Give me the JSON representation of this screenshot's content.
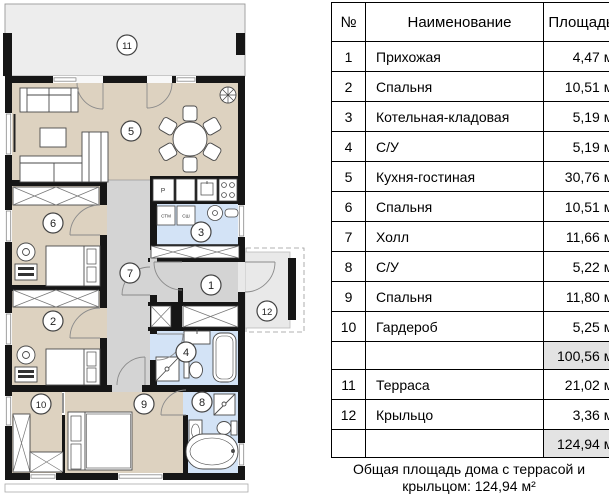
{
  "plan": {
    "circles": [
      "1",
      "2",
      "3",
      "4",
      "5",
      "6",
      "7",
      "8",
      "9",
      "10",
      "11",
      "12"
    ],
    "appliance_labels": {
      "fridge": "Р",
      "washer": "СТМ",
      "dryer": "СШ"
    },
    "colors": {
      "room_beige": "#ddd2c0",
      "wet_blue": "#d3e3f6",
      "hall_gray": "#d4d4d4",
      "terrace_gray": "#ededed",
      "porch_gray": "#e9e9e9",
      "wall_black": "#161616",
      "sum_cell_gray": "#e3e3e3"
    }
  },
  "table": {
    "headers": {
      "num": "№",
      "name": "Наименование",
      "area": "Площадь"
    },
    "rows": [
      {
        "num": "1",
        "name": "Прихожая",
        "area": "4,47 м²"
      },
      {
        "num": "2",
        "name": "Спальня",
        "area": "10,51 м²"
      },
      {
        "num": "3",
        "name": "Котельная-кладовая",
        "area": "5,19 м²"
      },
      {
        "num": "4",
        "name": "С/У",
        "area": "5,19 м²"
      },
      {
        "num": "5",
        "name": "Кухня-гостиная",
        "area": "30,76 м²"
      },
      {
        "num": "6",
        "name": "Спальня",
        "area": "10,51 м²"
      },
      {
        "num": "7",
        "name": "Холл",
        "area": "11,66 м²"
      },
      {
        "num": "8",
        "name": "С/У",
        "area": "5,22 м²"
      },
      {
        "num": "9",
        "name": "Спальня",
        "area": "11,80 м²"
      },
      {
        "num": "10",
        "name": "Гардероб",
        "area": "5,25 м²"
      },
      {
        "num": "",
        "name": "",
        "area": "100,56 м²"
      },
      {
        "num": "11",
        "name": "Терраса",
        "area": "21,02 м²"
      },
      {
        "num": "12",
        "name": "Крыльцо",
        "area": "3,36 м²"
      },
      {
        "num": "",
        "name": "",
        "area": "124,94 м²"
      }
    ],
    "footer": "Общая площадь дома с террасой и крыльцом: 124,94 м²"
  }
}
